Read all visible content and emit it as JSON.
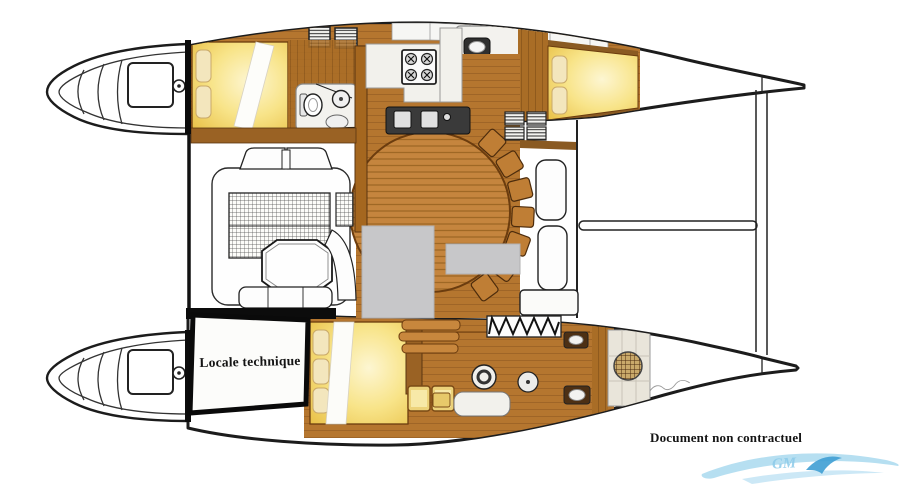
{
  "plan": {
    "technical_room_label": "Locale technique",
    "disclaimer": "Document non contractuel",
    "logo_text": "GM"
  },
  "colors": {
    "outline": "#1c1c1c",
    "wood": "#b5762f",
    "wood_light": "#c8873d",
    "wood_dark": "#8a5a22",
    "bed_yellow": "#f2d065",
    "pillow_cream": "#f3e6bd",
    "counter_dark": "#333333",
    "redaction_gray": "#c7c7c9",
    "tile": "#e9e5da",
    "logo_blue_light": "#a9d9ef",
    "logo_blue_dark": "#3f9fd4"
  }
}
